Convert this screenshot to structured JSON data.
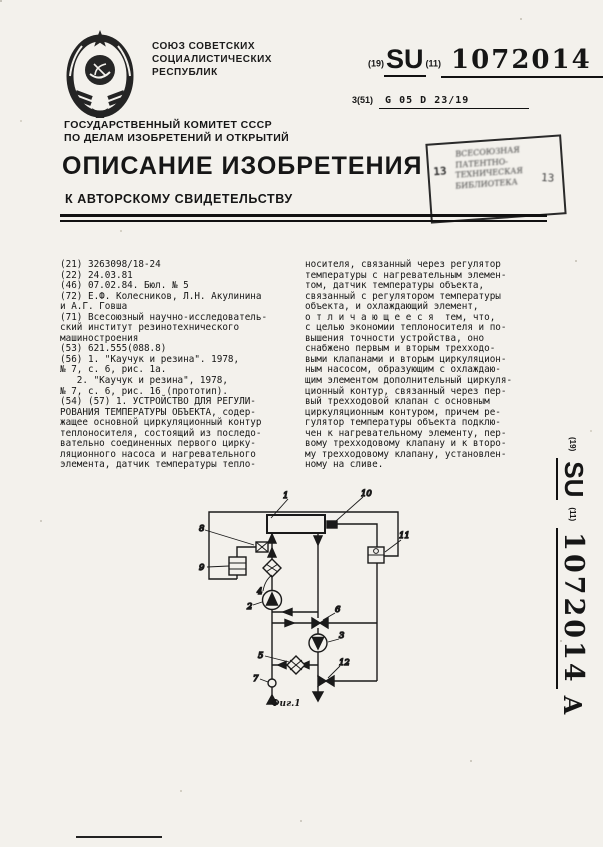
{
  "header": {
    "union_lines": [
      "СОЮЗ СОВЕТСКИХ",
      "СОЦИАЛИСТИЧЕСКИХ",
      "РЕСПУБЛИК"
    ],
    "code_19": "(19)",
    "country_code": "SU",
    "code_11": "(11)",
    "number": "1072014",
    "kind": "A",
    "ipc_prefix": "3(51)",
    "ipc_code": "G 05 D 23/19",
    "committee_lines": [
      "ГОСУДАРСТВЕННЫЙ КОМИТЕТ СССР",
      "ПО ДЕЛАМ ИЗОБРЕТЕНИЙ И ОТКРЫТИЙ"
    ],
    "doc_title": "ОПИСАНИЕ ИЗОБРЕТЕНИЯ",
    "doc_subtitle": "К АВТОРСКОМУ СВИДЕТЕЛЬСТВУ"
  },
  "stamp": {
    "lines": [
      "ВСЕСОЮЗНАЯ",
      "ПАТЕНТНО-",
      "ТЕХНИЧЕСКАЯ",
      "БИБЛИОТЕКА"
    ],
    "digit_left": "13",
    "digit_right": "13"
  },
  "body": {
    "left_lines": [
      "(21) 3263098/18-24",
      "(22) 24.03.81",
      "(46) 07.02.84. Бюл. № 5",
      "(72) Е.Ф. Колесников, Л.Н. Акулинина",
      "и А.Г. Говша",
      "(71) Всесоюзный научно-исследователь-",
      "ский институт резинотехнического",
      "машиностроения",
      "(53) 621.555(088.8)",
      "(56) 1. \"Каучук и резина\". 1978,",
      "№ 7, с. 6, рис. 1а.",
      "   2. \"Каучук и резина\", 1978,",
      "№ 7, с. 6, рис. 16 (прототип).",
      "(54) (57) 1. УСТРОЙСТВО ДЛЯ РЕГУЛИ-",
      "РОВАНИЯ ТЕМПЕРАТУРЫ ОБЪЕКТА, содер-",
      "жащее основной циркуляционный контур",
      "теплоносителя, состоящий из последо-",
      "вательно соединенных первого цирку-",
      "ляционного насоса и нагревательного",
      "элемента, датчик температуры тепло-"
    ],
    "right_lines": [
      "носителя, связанный через регулятор",
      "температуры с нагревательным элемен-",
      "том, датчик температуры объекта,",
      "связанный с регулятором температуры",
      "объекта, и охлаждающий элемент,",
      "о т л и ч а ю щ е е с я  тем, что,",
      "с целью экономии теплоносителя и по-",
      "вышения точности устройства, оно",
      "снабжено первым и вторым трехходо-",
      "выми клапанами и вторым циркуляцион-",
      "ным насосом, образующим с охлаждаю-",
      "щим элементом дополнительный циркуля-",
      "ционный контур, связанный через пер-",
      "вый трехходовой клапан с основным",
      "циркуляционным контуром, причем ре-",
      "гулятор температуры объекта подклю-",
      "чен к нагревательному элементу, пер-",
      "вому трехходовому клапану и к второ-",
      "му трехходовому клапану, установлен-",
      "ному на сливе."
    ]
  },
  "sidebar": {
    "code_19": "(19)",
    "country_code": "SU",
    "code_11": "(11)",
    "number": "1072014",
    "kind": "A"
  },
  "figure": {
    "caption": "Фиг.1",
    "labels": {
      "object": "1",
      "pump1": "2",
      "pump2": "3",
      "heater": "4",
      "cooler": "5",
      "valve1": "6",
      "makeup_valve": "7",
      "coolant_sensor": "8",
      "coolant_regulator": "9",
      "object_sensor": "10",
      "object_regulator": "11",
      "valve2": "12"
    }
  }
}
